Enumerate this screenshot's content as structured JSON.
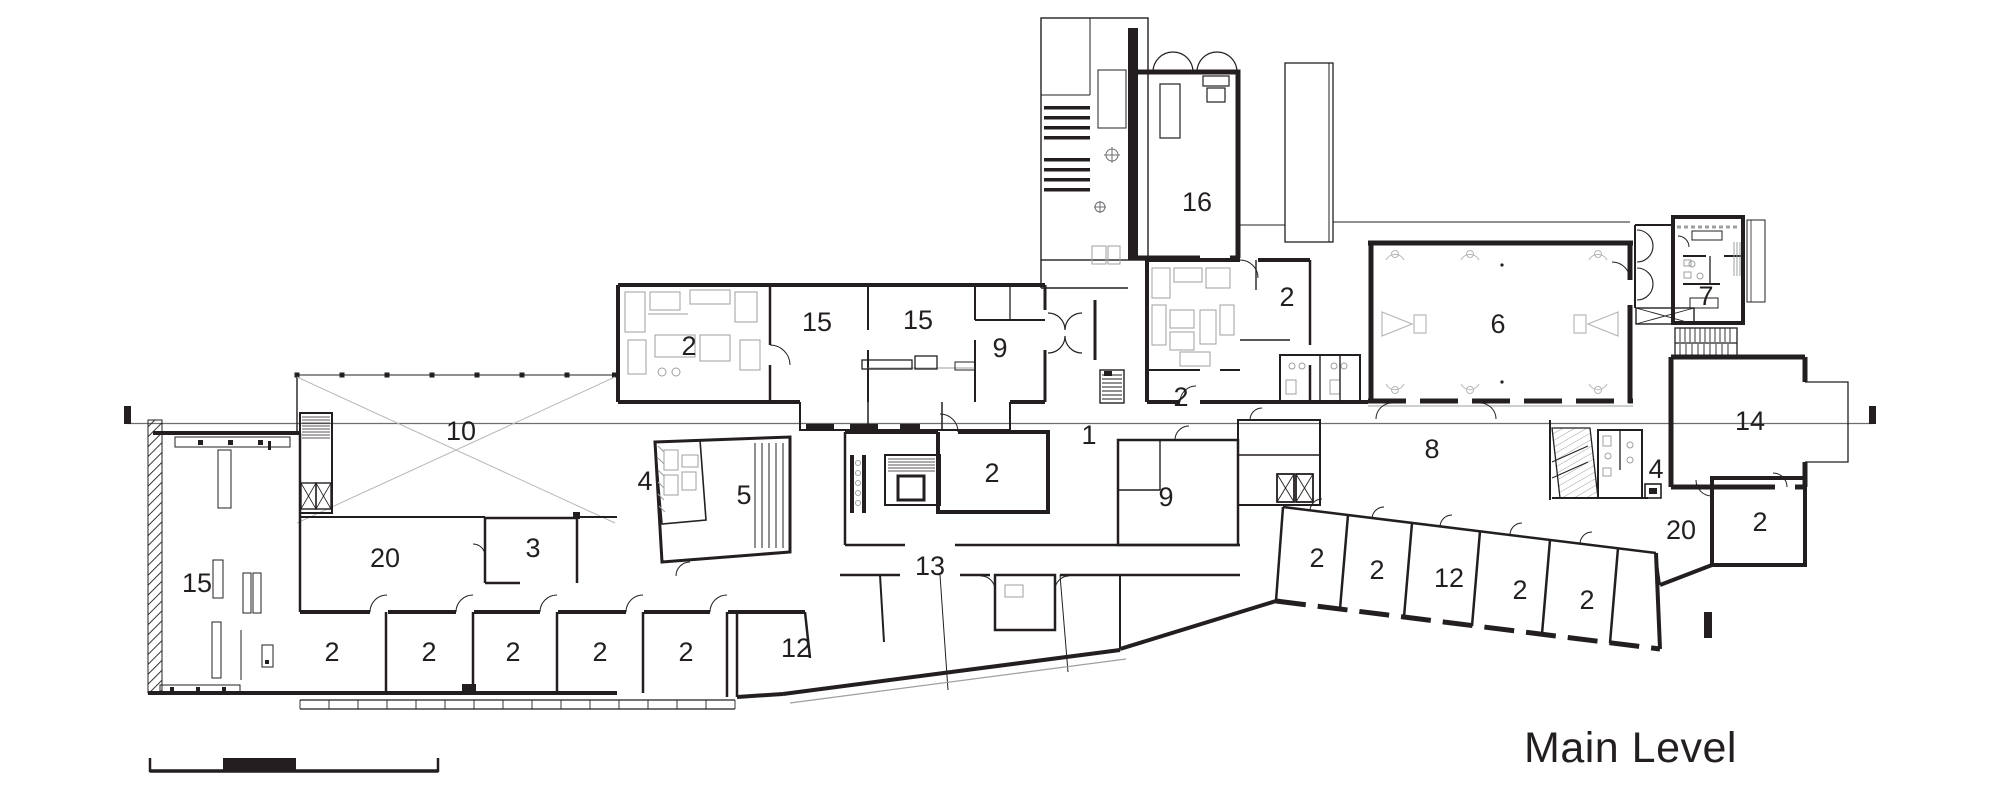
{
  "title": "Main Level",
  "drawing": {
    "type": "architectural floor plan",
    "level_label": "Main Level"
  },
  "colors": {
    "wall": "#231f20",
    "detail_gray": "#9d9fa2",
    "light_gray": "#bfc1c4",
    "section_line": "#6d6e71",
    "background": "#ffffff"
  },
  "rooms": [
    {
      "label": "16"
    },
    {
      "label": "2"
    },
    {
      "label": "15"
    },
    {
      "label": "15"
    },
    {
      "label": "9"
    },
    {
      "label": "2"
    },
    {
      "label": "2"
    },
    {
      "label": "6"
    },
    {
      "label": "7"
    },
    {
      "label": "10"
    },
    {
      "label": "1"
    },
    {
      "label": "8"
    },
    {
      "label": "14"
    },
    {
      "label": "4"
    },
    {
      "label": "9"
    },
    {
      "label": "2"
    },
    {
      "label": "4"
    },
    {
      "label": "5"
    },
    {
      "label": "13"
    },
    {
      "label": "15"
    },
    {
      "label": "20"
    },
    {
      "label": "3"
    },
    {
      "label": "2"
    },
    {
      "label": "2"
    },
    {
      "label": "2"
    },
    {
      "label": "2"
    },
    {
      "label": "2"
    },
    {
      "label": "12"
    },
    {
      "label": "2"
    },
    {
      "label": "2"
    },
    {
      "label": "12"
    },
    {
      "label": "2"
    },
    {
      "label": "2"
    },
    {
      "label": "20"
    },
    {
      "label": "2"
    }
  ]
}
